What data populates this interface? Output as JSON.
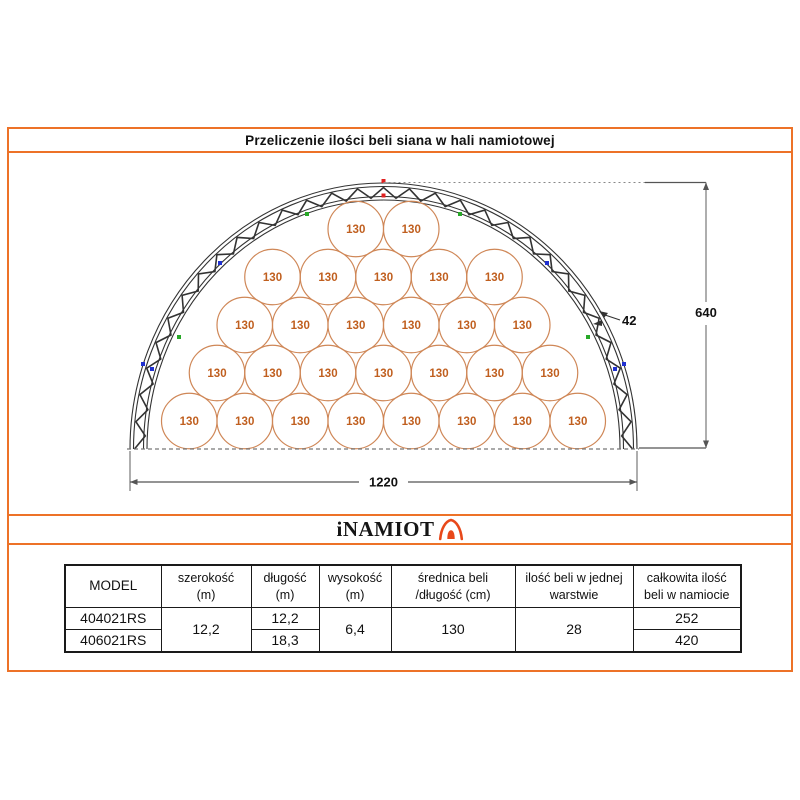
{
  "page": {
    "title": "Przeliczenie ilości beli siana w hali namiotowej"
  },
  "logo": {
    "text": "iNAMIOT"
  },
  "drawing": {
    "bale_label": "130",
    "bale_rows_top_to_bottom": [
      2,
      5,
      6,
      7,
      8
    ],
    "bales_per_layer": 28,
    "dim_width": "1220",
    "dim_height": "640",
    "dim_truss": "42"
  },
  "table": {
    "headers": {
      "model": [
        "MODEL"
      ],
      "szerokosc": [
        "szerokość",
        "(m)"
      ],
      "dlugosc": [
        "długość",
        "(m)"
      ],
      "wysokosc": [
        "wysokość",
        "(m)"
      ],
      "srednica": [
        "średnica beli",
        "/długość (cm)"
      ],
      "ilosc": [
        "ilość beli w jednej",
        "warstwie"
      ],
      "calkowita": [
        "całkowita ilość",
        "beli w namiocie"
      ]
    },
    "models": [
      "404021RS",
      "406021RS"
    ],
    "szerokosc": "12,2",
    "dlugosc": [
      "12,2",
      "18,3"
    ],
    "wysokosc": "6,4",
    "srednica": "130",
    "ilosc_warstwa": "28",
    "calkowita": [
      "252",
      "420"
    ]
  },
  "colors": {
    "frame_orange": "#ed7228",
    "logo_tent": "#e8481a",
    "bale_stroke": "#cf8757",
    "bale_text": "#c05f1f",
    "truss": "#333333",
    "dim_line": "#6e6e6e",
    "marker_red": "#e02020",
    "marker_green": "#28a828",
    "marker_blue": "#2030d0"
  }
}
